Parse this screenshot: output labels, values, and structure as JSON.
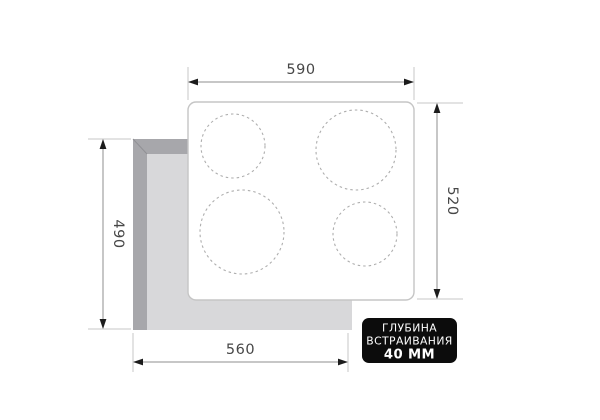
{
  "diagram": {
    "title": "cooktop-built-in-cutout-dimensions",
    "dimensions": {
      "top_width": "590",
      "right_height": "520",
      "left_height": "490",
      "bottom_width": "560"
    },
    "badge": {
      "line1": "ГЛУБИНА",
      "line2": "ВСТРАИВАНИЯ",
      "line3": "40 ММ",
      "bg": "#0c0c0c",
      "text_color": "#ffffff"
    },
    "burners": [
      {
        "position": "top-left",
        "size": "medium"
      },
      {
        "position": "top-right",
        "size": "large"
      },
      {
        "position": "bottom-left",
        "size": "large"
      },
      {
        "position": "bottom-right",
        "size": "medium"
      }
    ],
    "colors": {
      "background": "#ffffff",
      "cutout_face": "#d8d8da",
      "cutout_bevel": "#a7a7ab",
      "panel_border": "#c5c5c5",
      "burner_stroke": "#aeaeae",
      "dimension_line": "#8f8f8f",
      "extension_line": "#c7c7c7",
      "arrowhead": "#1c1c1c",
      "dimension_text": "#474747"
    }
  }
}
